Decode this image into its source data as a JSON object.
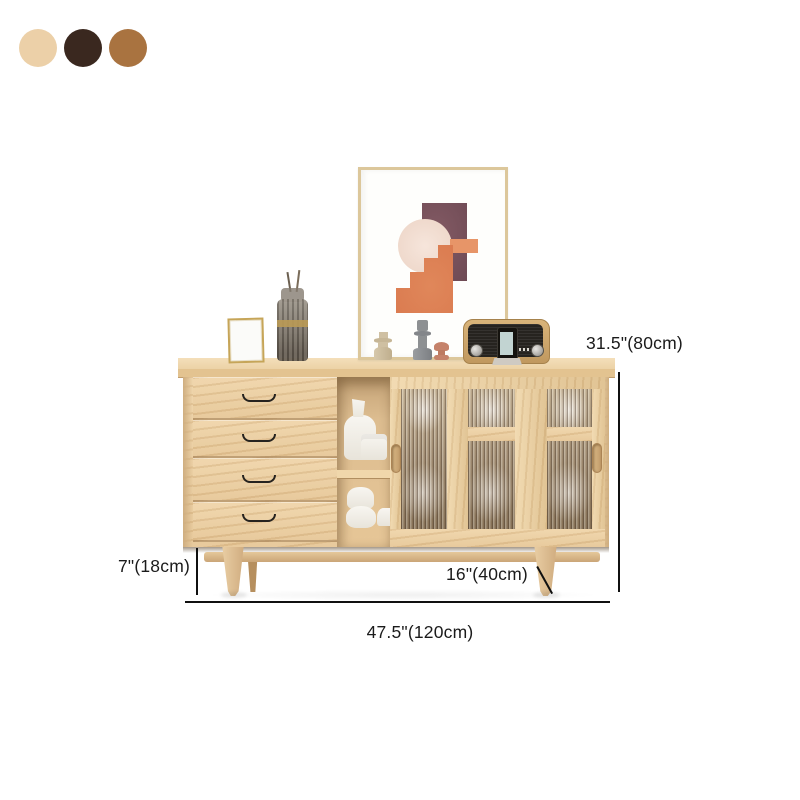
{
  "color_swatches": [
    {
      "name": "cream",
      "hex": "#ecd0a8"
    },
    {
      "name": "dark-brown",
      "hex": "#3a281f"
    },
    {
      "name": "brown",
      "hex": "#a97340"
    }
  ],
  "dimensions": {
    "height": "31.5\"(80cm)",
    "leg_height": "7\"(18cm)",
    "depth": "16\"(40cm)",
    "width": "47.5\"(120cm)"
  },
  "annotation_color": "#101010"
}
